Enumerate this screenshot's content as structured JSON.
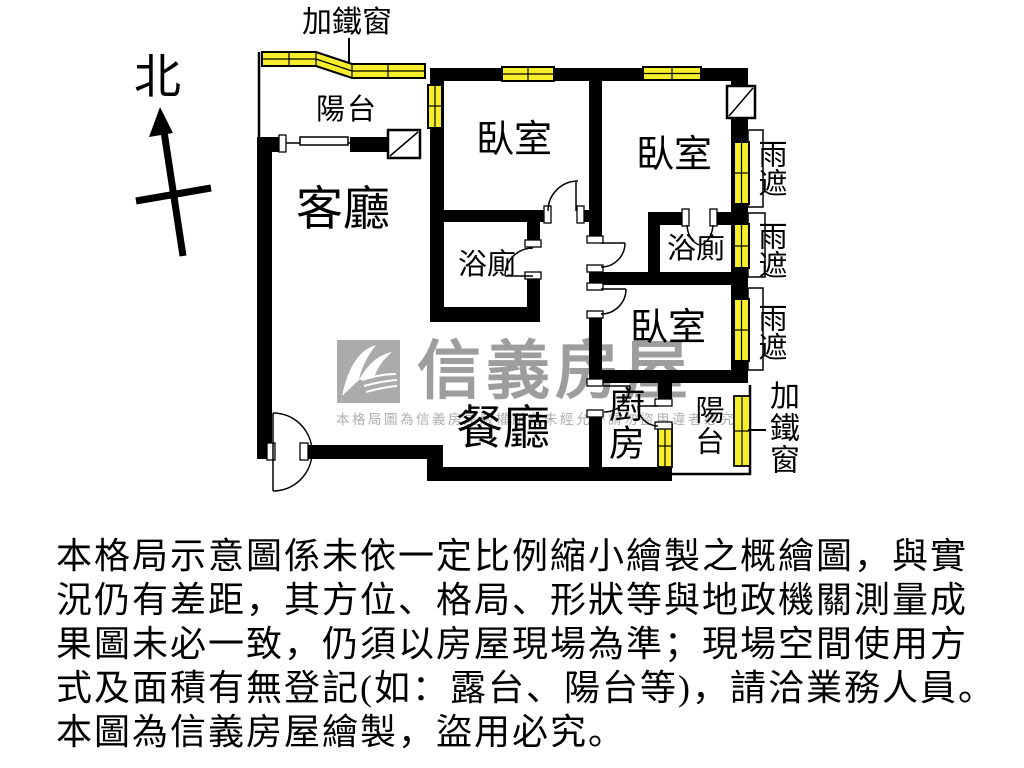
{
  "compass": {
    "north_label": "北"
  },
  "plan": {
    "rooms": {
      "balcony_front": "陽台",
      "living_room": "客廳",
      "bedroom_1": "臥室",
      "bedroom_2": "臥室",
      "bedroom_3": "臥室",
      "bathroom_1": "浴廁",
      "bathroom_2": "浴廁",
      "dining_room": "餐廳",
      "kitchen": "廚房",
      "balcony_rear": "陽台"
    },
    "annotations": {
      "iron_window_top": "加鐵窗",
      "iron_window_right": "加鐵窗",
      "rain_cover_1": "雨遮",
      "rain_cover_2": "雨遮",
      "rain_cover_3": "雨遮"
    }
  },
  "watermark": {
    "brand": "信義房屋",
    "notice": "本格局圖為信義房屋版權所有未經允許請勿盜用違者必究"
  },
  "disclaimer": {
    "lines": [
      "本格局示意圖係未依一定比例縮小繪製之概繪圖，與實",
      "況仍有差距，其方位、格局、形狀等與地政機關測量成",
      "果圖未必一致，仍須以房屋現場為準；現場空間使用方",
      "式及面積有無登記(如：露台、陽台等)，請洽業務人員。",
      "本圖為信義房屋繪製，盜用必究。"
    ]
  },
  "colors": {
    "window_yellow": "#F6EE2B",
    "wall_black": "#000000",
    "watermark_gray": "#9D9D9D"
  }
}
